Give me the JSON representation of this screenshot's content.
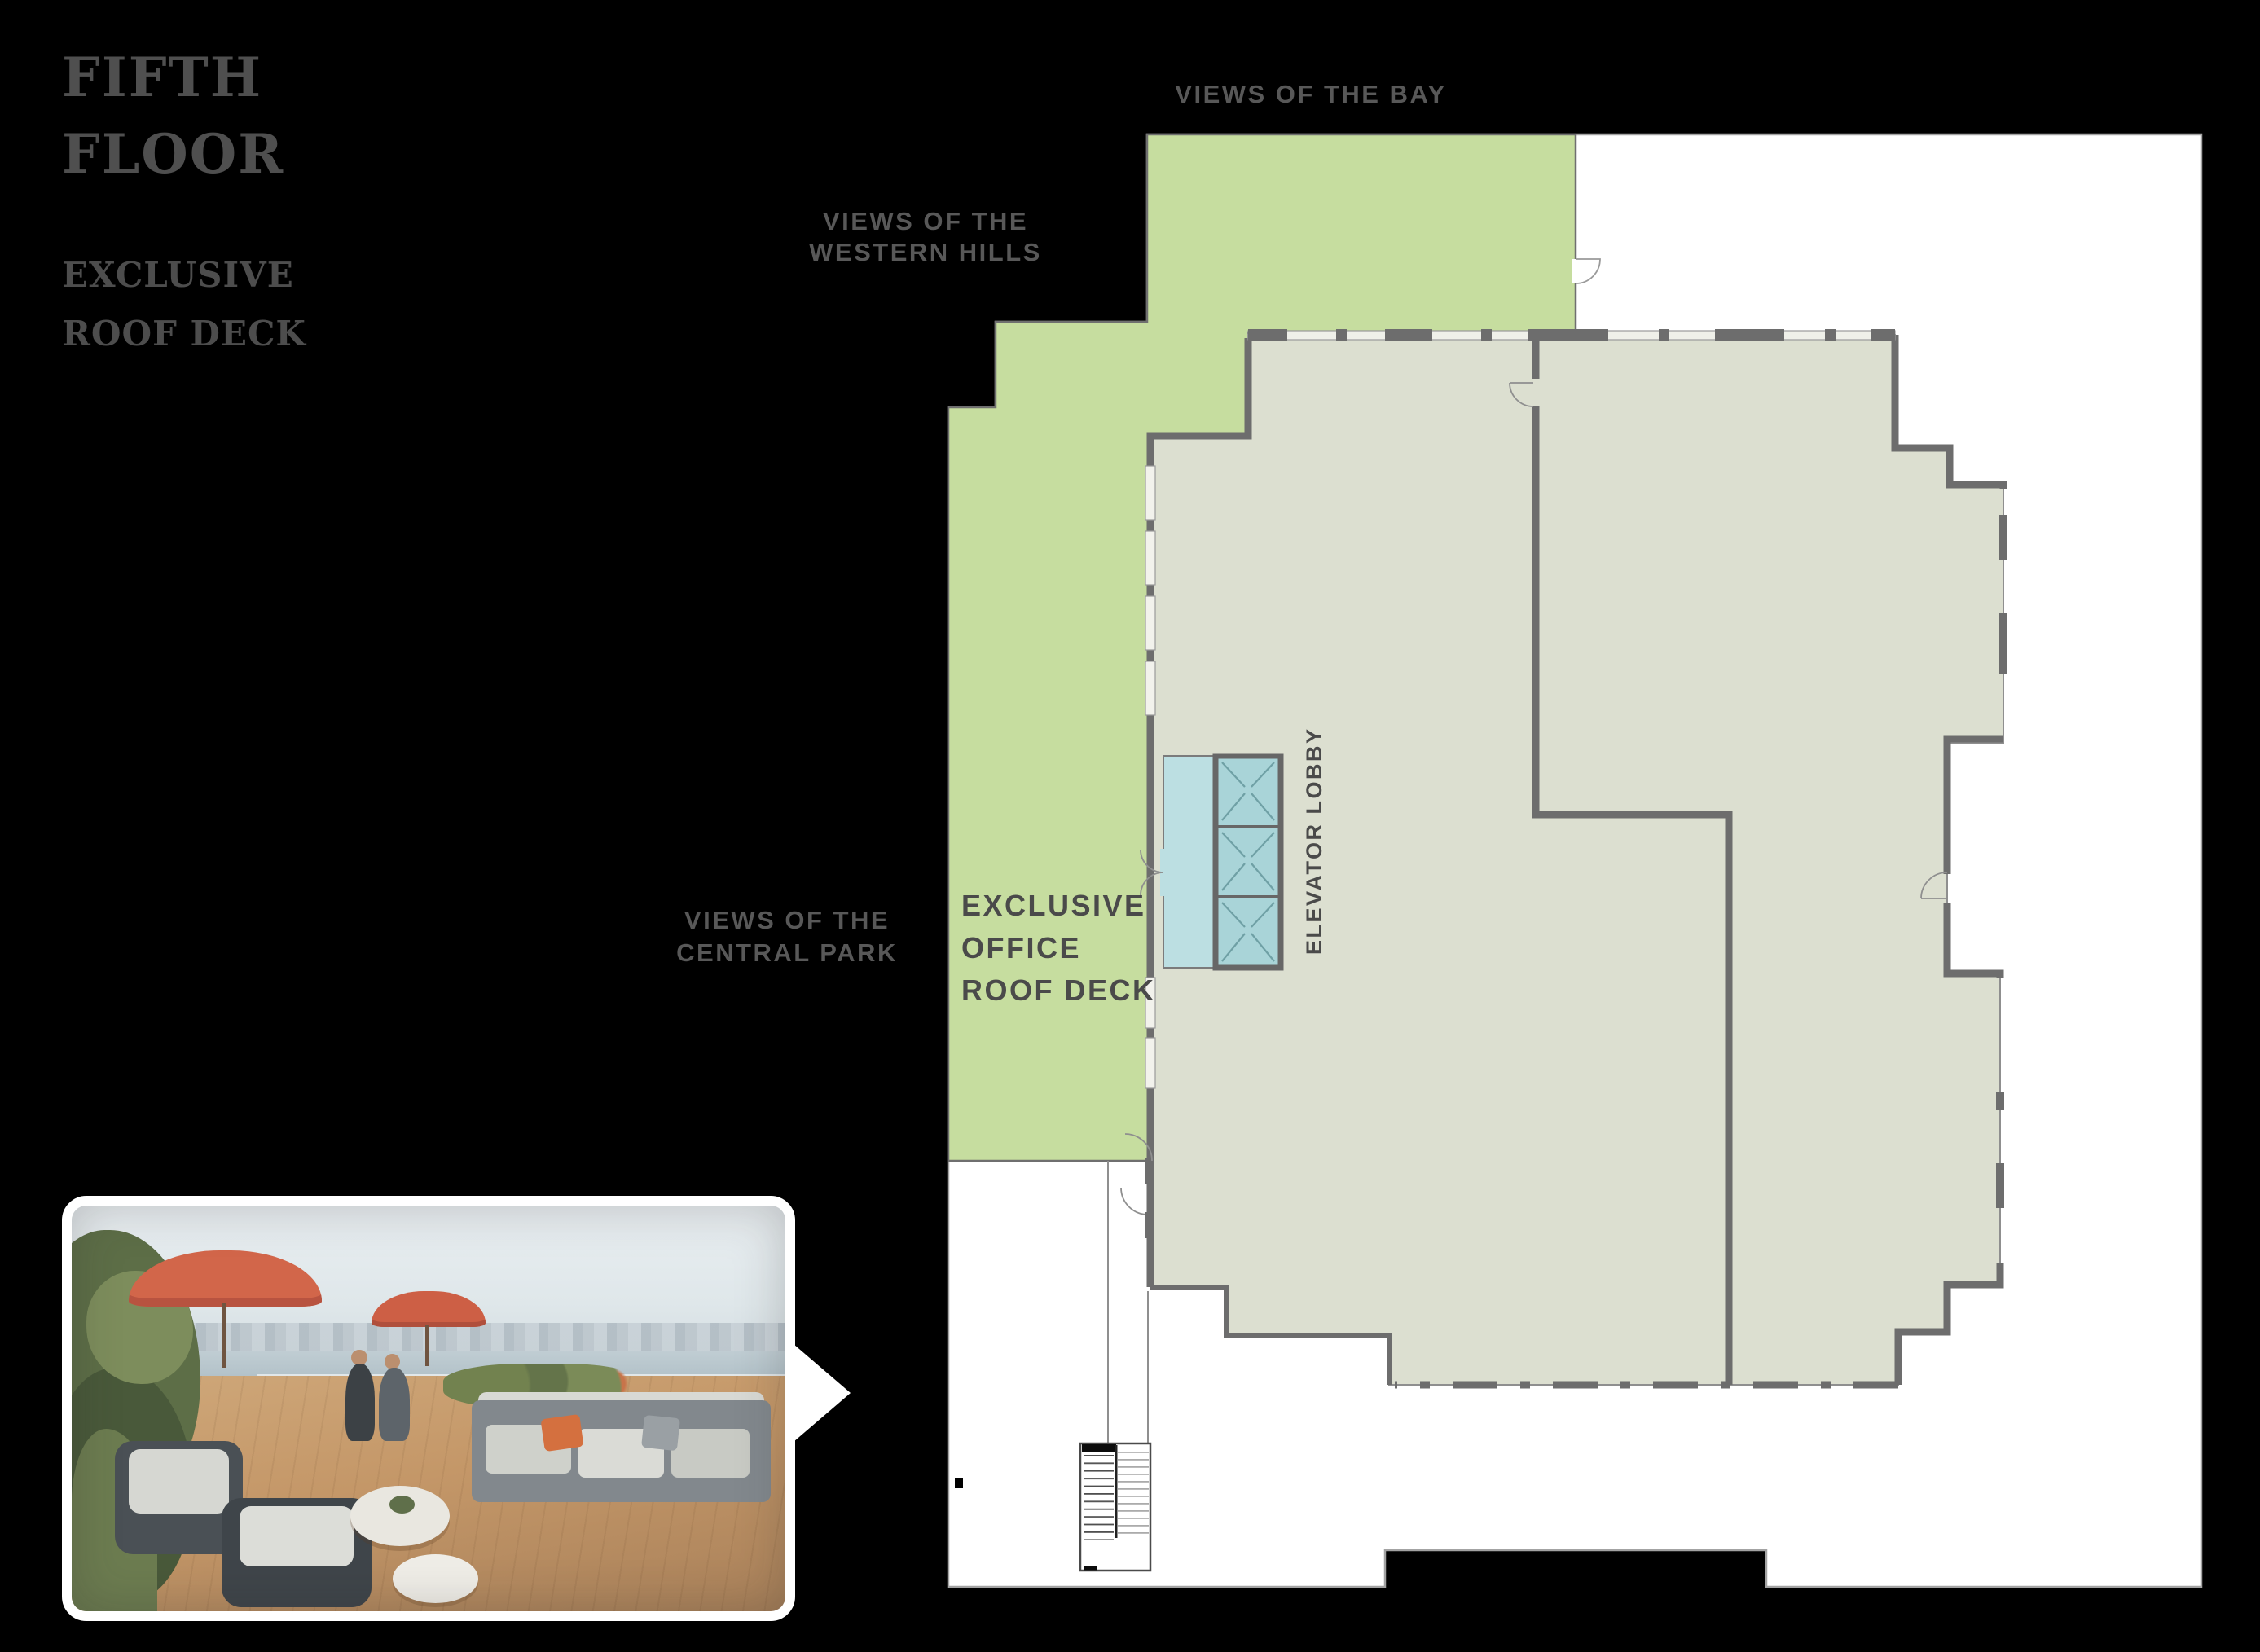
{
  "page": {
    "background": "#000000"
  },
  "header": {
    "title_line1": "FIFTH",
    "title_line2": "FLOOR",
    "subtitle_line1": "EXCLUSIVE",
    "subtitle_line2": "ROOF DECK"
  },
  "plan": {
    "labels": {
      "views_bay": "VIEWS OF THE BAY",
      "views_western_line1": "VIEWS OF THE",
      "views_western_line2": "WESTERN HILLS",
      "views_central_line1": "VIEWS OF THE",
      "views_central_line2": "CENTRAL PARK",
      "office_deck_line1": "EXCLUSIVE",
      "office_deck_line2": "OFFICE",
      "office_deck_line3": "ROOF DECK",
      "elevator_lobby": "ELEVATOR LOBBY"
    },
    "colors": {
      "roof_deck_green": "#c6dd9f",
      "elevator_teal": "#a9d4d8",
      "lobby_teal": "#bcdfe2",
      "interior_gray_green": "#dcdfd0",
      "wall_gray": "#6d6d6d",
      "slab_white": "#ffffff",
      "label_gray_on_plan": "#4a4a4a",
      "label_gray_on_black": "#585858"
    }
  }
}
